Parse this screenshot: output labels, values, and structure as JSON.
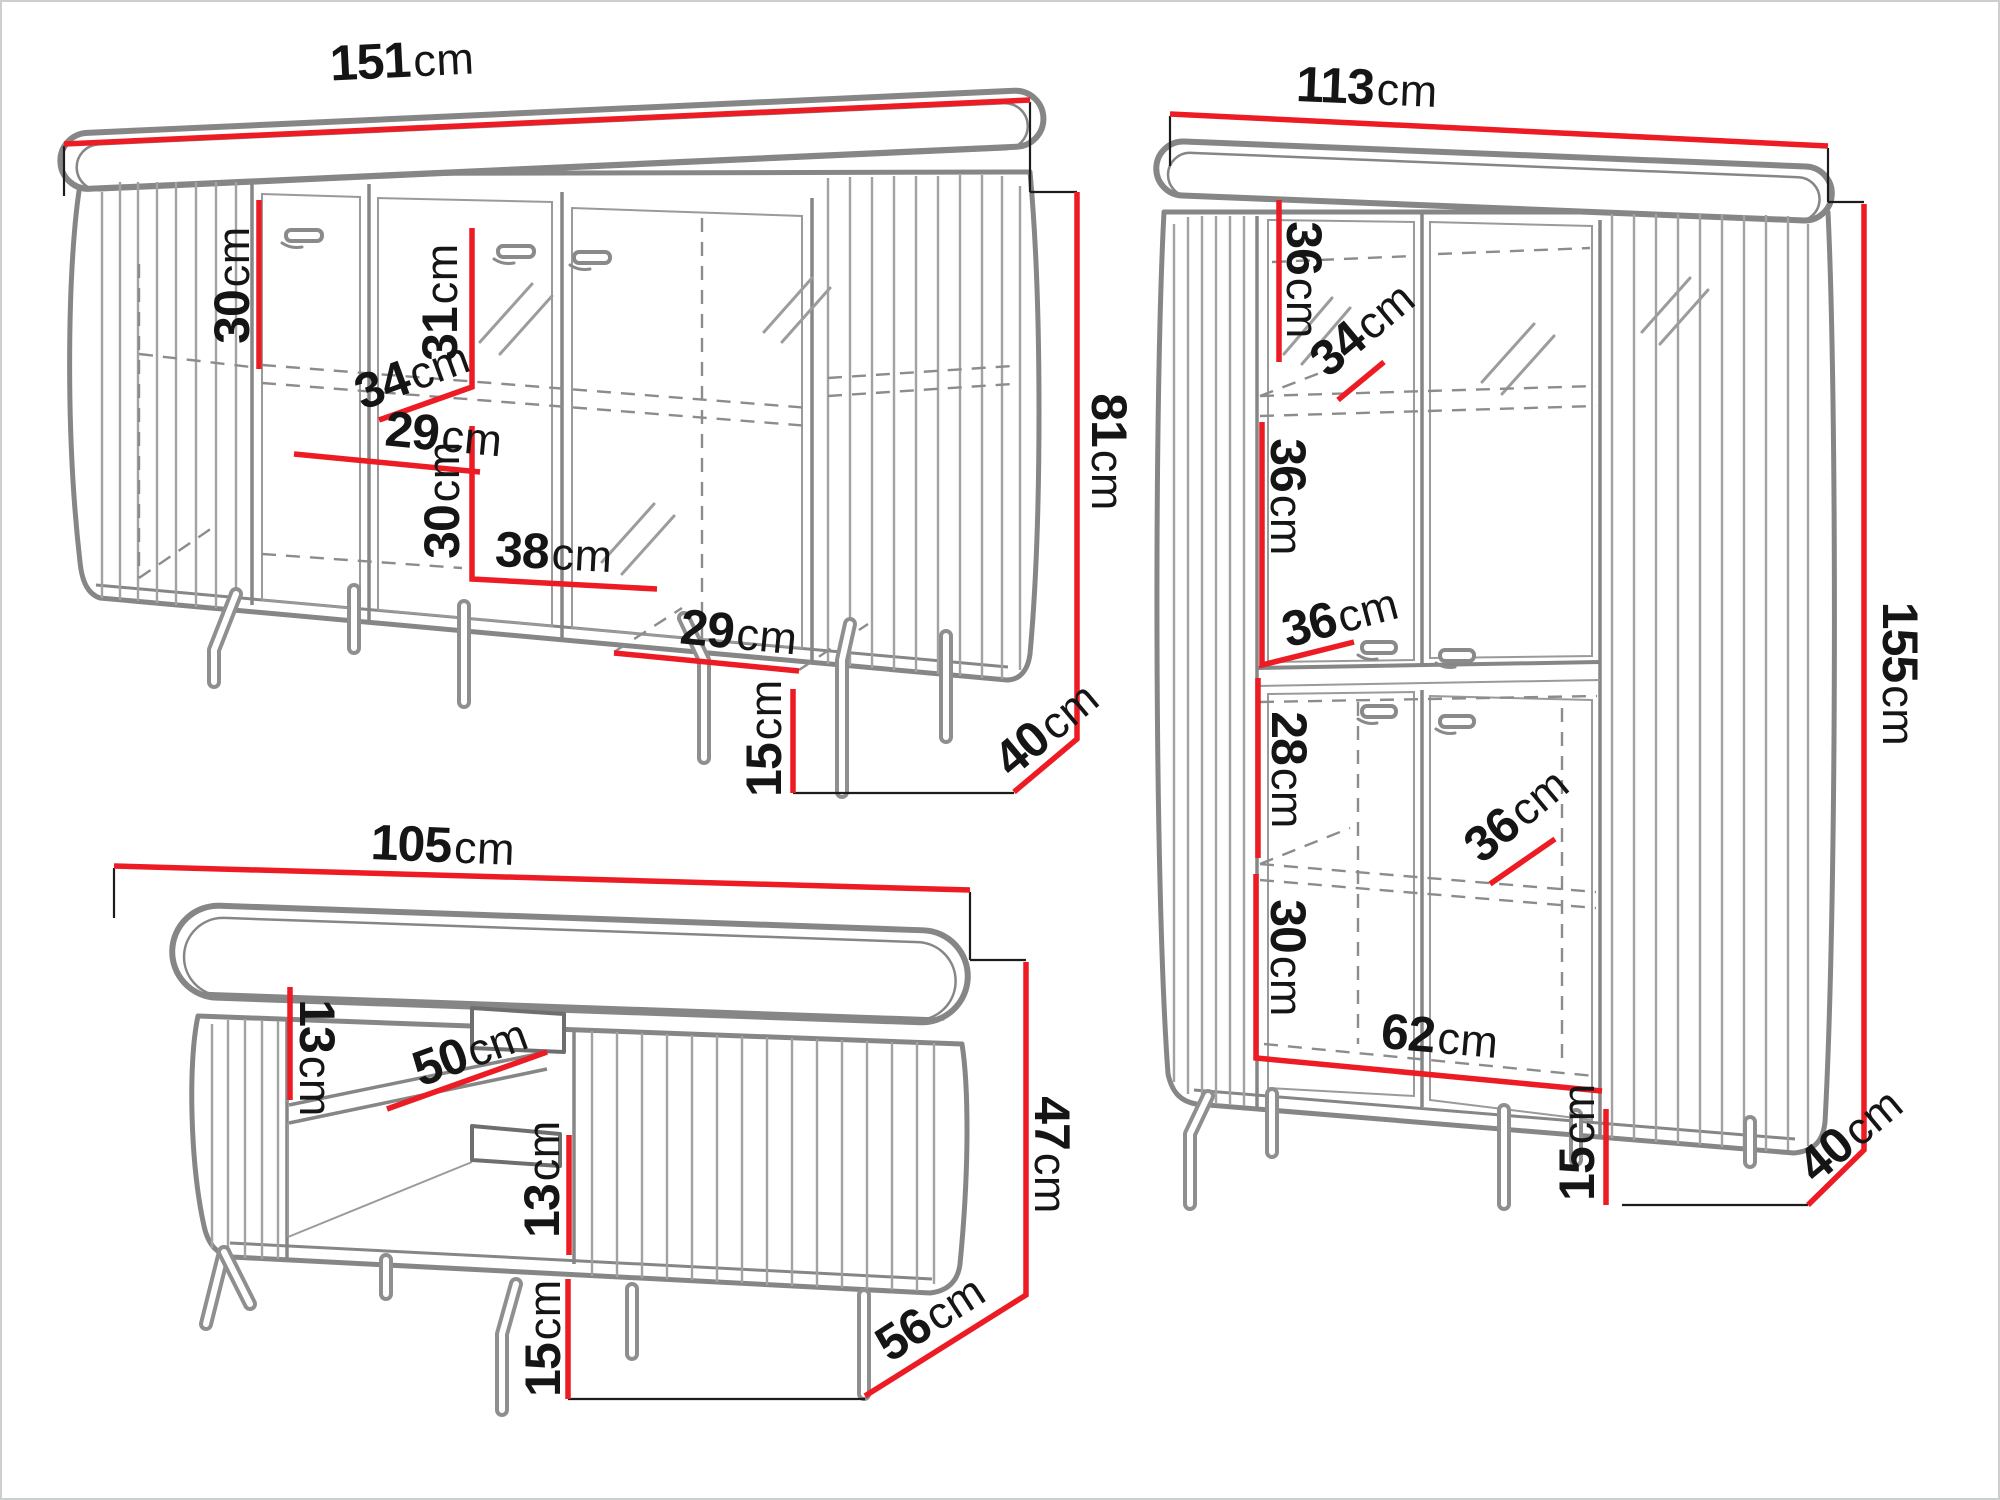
{
  "colors": {
    "dimension_red": "#ec1b24",
    "outline_gray": "#868686",
    "label_black": "#151515",
    "background": "#ffffff",
    "frame_border": "#cbcfcf"
  },
  "units": {
    "cm": "cm"
  },
  "sideboard": {
    "width": "151",
    "height": "81",
    "depth": "40",
    "leg_height": "15",
    "inner_top_height": "30",
    "glass_door_height": "31",
    "shelf_depth": "34",
    "inner_bottom_height": "30",
    "inner_center_width": "38",
    "inner_left_width": "29",
    "inner_right_width": "29"
  },
  "display_cabinet": {
    "width": "113",
    "height": "155",
    "depth": "40",
    "leg_height": "15",
    "upper_inner_height": "36",
    "upper_shelf_depth": "34",
    "upper_left_height": "36",
    "middle_shelf_depth": "36",
    "lower_top_height": "28",
    "lower_shelf_depth": "36",
    "lower_bottom_height": "30",
    "lower_inner_width": "62"
  },
  "coffee_table": {
    "width": "105",
    "height": "47",
    "depth": "56",
    "leg_height": "15",
    "upper_niche_height": "13",
    "shelf_width": "50",
    "lower_niche_height": "13"
  }
}
